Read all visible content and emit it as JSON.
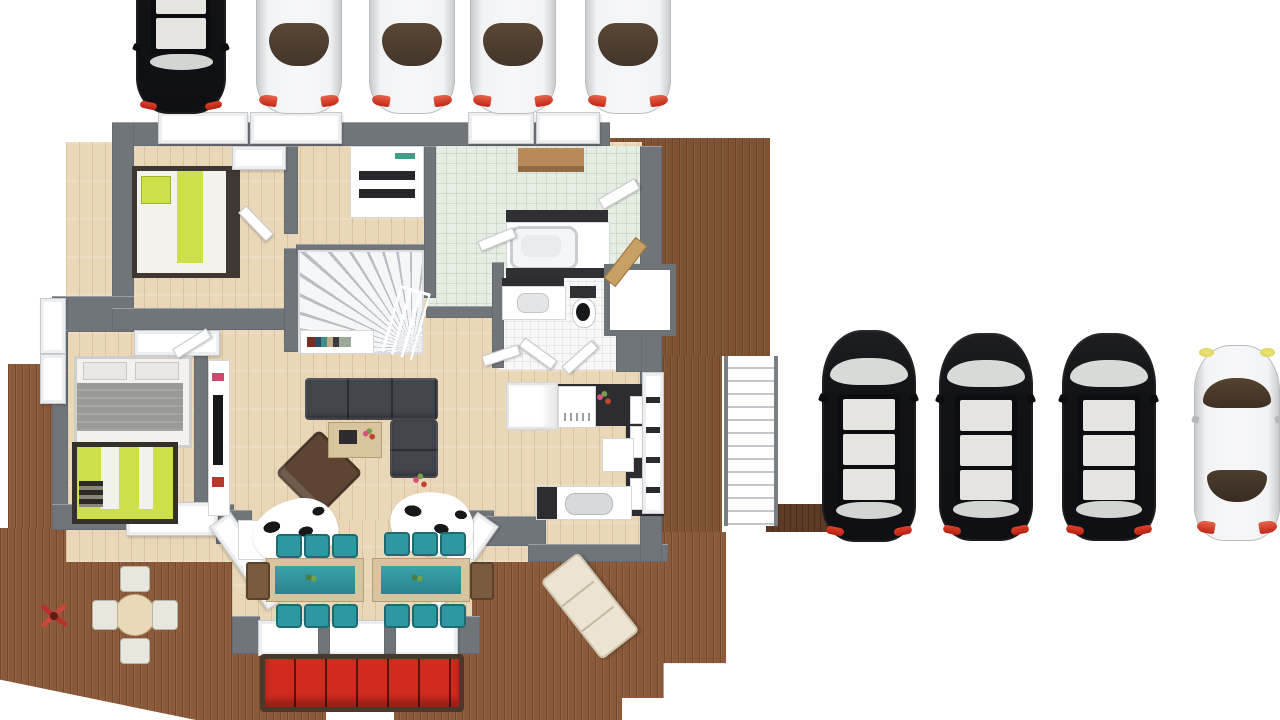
{
  "scene": {
    "type": "3d-floor-plan-top-down-render",
    "background": "#ffffff",
    "text_visible": "none"
  },
  "palette": {
    "deck_wood": "#8a5a3a",
    "dark_walkway": "#5d3b25",
    "interior_wood_floor": "#ead7b8",
    "pale_green_tile": "#e6ede2",
    "white_tile": "#f7f8f7",
    "wall_gray": "#70757a",
    "sofa_dark_gray": "#42454b",
    "armchair_brown": "#5e4533",
    "accent_teal": "#2f97a0",
    "accent_lime": "#cde04a",
    "outdoor_sofa_red": "#d12a1e",
    "car_black": "#131418",
    "car_white": "#eceded",
    "taillight_red": "#c22718",
    "headlight_yellow": "#e8e06a"
  },
  "vehicles": {
    "top_row": [
      {
        "type": "suv",
        "color": "black",
        "facing": "down",
        "clipped_top": true
      },
      {
        "type": "sedan",
        "color": "white",
        "facing": "down",
        "clipped_top": true
      },
      {
        "type": "sedan",
        "color": "white",
        "facing": "down",
        "clipped_top": true
      },
      {
        "type": "sedan",
        "color": "white",
        "facing": "down",
        "clipped_top": true
      },
      {
        "type": "sedan",
        "color": "white",
        "facing": "down",
        "clipped_top": true
      }
    ],
    "right_row": [
      {
        "type": "suv",
        "color": "black",
        "facing": "up"
      },
      {
        "type": "suv",
        "color": "black",
        "facing": "up"
      },
      {
        "type": "suv",
        "color": "black",
        "facing": "up"
      },
      {
        "type": "sedan",
        "color": "white",
        "facing": "up",
        "headlights": "yellow"
      }
    ]
  },
  "house": {
    "rooms": [
      {
        "name": "bedroom-top-left",
        "floor": "wood",
        "furniture": [
          "lime-single-bed"
        ]
      },
      {
        "name": "hallway-with-stairs",
        "floor": "wood",
        "furniture": [
          "winder-staircase",
          "stair-railing",
          "under-stair-bookshelf",
          "laundry-closet"
        ]
      },
      {
        "name": "entry-hall",
        "floor": "pale-green-tile",
        "furniture": [
          "wooden-bench"
        ]
      },
      {
        "name": "bathroom",
        "floor": "white-tile",
        "furniture": [
          "bathtub",
          "washbasin",
          "toilet",
          "dark-vanity"
        ]
      },
      {
        "name": "master-bedroom",
        "floor": "wood",
        "furniture": [
          "gray-double-bed",
          "lime-bunk-bed",
          "wardrobe-row",
          "tv-sideboard"
        ]
      },
      {
        "name": "living-room",
        "floor": "wood",
        "furniture": [
          "dark-sectional-sofa",
          "brown-armchair",
          "coffee-table",
          "cowhide-rug",
          "cowhide-rug",
          "flower-pot"
        ]
      },
      {
        "name": "dining-area",
        "floor": "wood",
        "furniture": [
          "dining-table-teal-runner",
          "dining-table-teal-runner",
          "teal-chairs",
          "brown-end-bench",
          "bay-window"
        ]
      },
      {
        "name": "kitchen",
        "floor": "wood",
        "furniture": [
          "dark-l-counter",
          "fridge",
          "stove",
          "tall-cabinet-column",
          "sink-counter",
          "dishwasher"
        ]
      }
    ]
  },
  "outdoor": {
    "decks": [
      "north-east-deck",
      "east-strip-deck",
      "west-strip-deck",
      "south-deck",
      "dark-walkway-to-parking"
    ],
    "features": [
      "exterior-staircase",
      "deck-door-open",
      "white-porch-alcove",
      "porch-step-notch"
    ],
    "furniture": [
      "round-table-with-4-chairs",
      "red-pinwheel-decor",
      "cream-lounge-chair",
      "red-outdoor-sofa",
      "small-wood-bench"
    ]
  },
  "counts": {
    "cars_total": 9,
    "black_suvs": 4,
    "white_sedans": 5,
    "teal_dining_chairs": 12,
    "round_table_chairs": 4,
    "red_sofa_cushions": 6,
    "beds": 3
  }
}
